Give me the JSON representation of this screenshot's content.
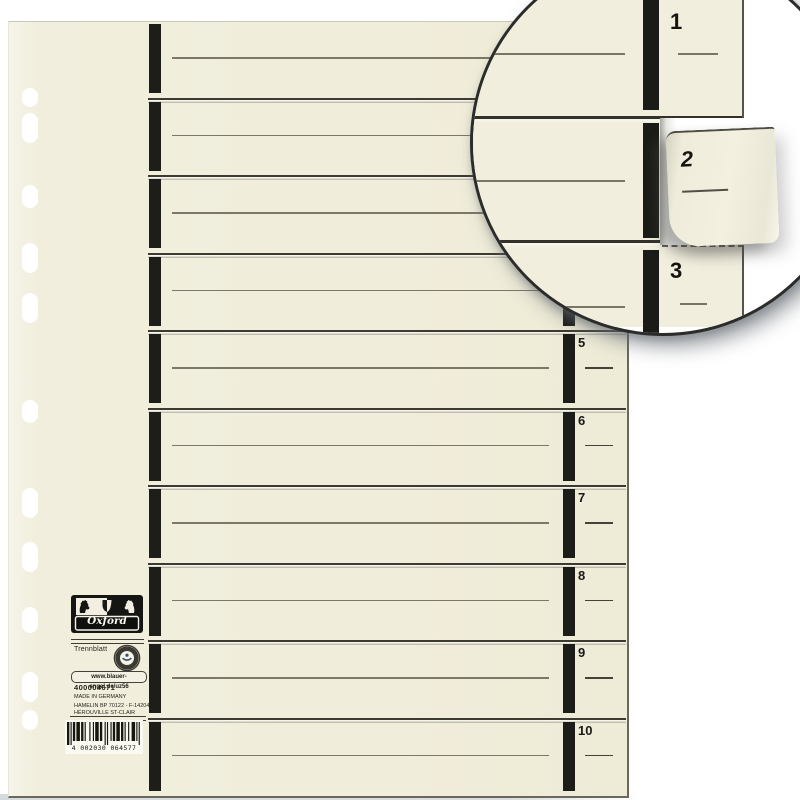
{
  "product": {
    "brand": "Oxford",
    "name": "Trennblatt",
    "article_number": "400004671",
    "made_in": "MADE IN GERMANY",
    "manufacturer_line1": "HAMELIN  BP 70122 - F-14204",
    "manufacturer_line2": "HÉROUVILLE ST-CLAIR",
    "eco_label": "www.blauer-engel.de/uz56",
    "barcode_digits": "4 002030 064577"
  },
  "tabs": {
    "labels": [
      "1",
      "2",
      "3",
      "4",
      "5",
      "6",
      "7",
      "8",
      "9",
      "10"
    ]
  },
  "inset": {
    "tab_top": "1",
    "tab_torn": "2",
    "tab_bottom": "3"
  },
  "icons": {
    "crest": "oxford-crest-icon",
    "eco": "blauer-engel-icon"
  },
  "colors": {
    "paper": "#f1eedd",
    "tab_mark": "#1d1d1a",
    "divider_line": "#3c3a31",
    "writing_line": "#7d7767",
    "background": "#ffffff",
    "circle_border": "#2c2c2a"
  }
}
